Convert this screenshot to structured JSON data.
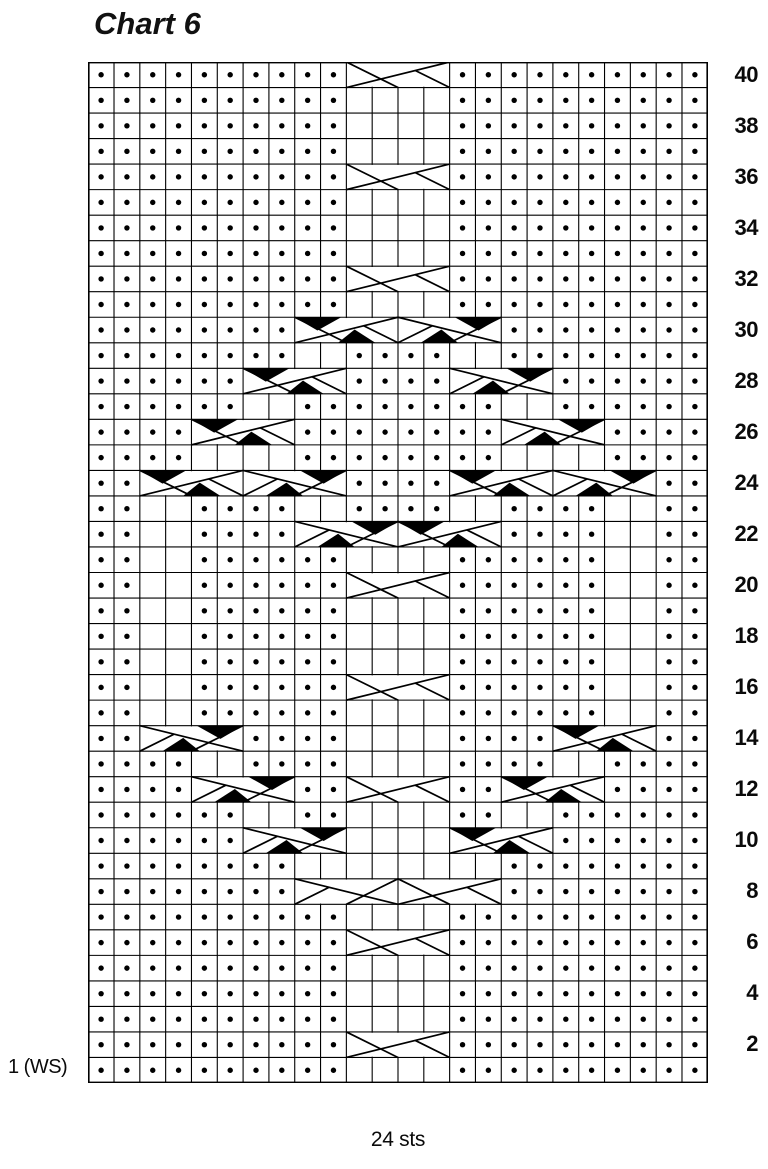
{
  "title": "Chart 6",
  "labels": {
    "row1_left": "1 (WS)",
    "stitch_count": "24 sts"
  },
  "colors": {
    "ink": "#000000",
    "background": "#ffffff"
  },
  "chart": {
    "columns": 24,
    "rows_total": 40,
    "encoding": {
      ".": "purl-dot",
      " ": "knit-blank",
      "R": "cable-4st-right-cross-white",
      "L": "cable-4st-left-cross-white",
      "r": "cable-4st-right-cross-black",
      "l": "cable-4st-left-cross-black",
      "-": "cable-continuation"
    },
    "rows": [
      {
        "n": 40,
        "right": "40",
        "left": "",
        "cells": "..........R---.........."
      },
      {
        "n": 39,
        "right": "",
        "left": "",
        "cells": "..........    .........."
      },
      {
        "n": 38,
        "right": "38",
        "left": "",
        "cells": "..........    .........."
      },
      {
        "n": 37,
        "right": "",
        "left": "",
        "cells": "..........    .........."
      },
      {
        "n": 36,
        "right": "36",
        "left": "",
        "cells": "..........R---.........."
      },
      {
        "n": 35,
        "right": "",
        "left": "",
        "cells": "..........    .........."
      },
      {
        "n": 34,
        "right": "34",
        "left": "",
        "cells": "..........    .........."
      },
      {
        "n": 33,
        "right": "",
        "left": "",
        "cells": "..........    .........."
      },
      {
        "n": 32,
        "right": "32",
        "left": "",
        "cells": "..........R---.........."
      },
      {
        "n": 31,
        "right": "",
        "left": "",
        "cells": "..........    .........."
      },
      {
        "n": 30,
        "right": "30",
        "left": "",
        "cells": "........r---l---........"
      },
      {
        "n": 29,
        "right": "",
        "left": "",
        "cells": "........  ....  ........"
      },
      {
        "n": 28,
        "right": "28",
        "left": "",
        "cells": "......r---....l---......"
      },
      {
        "n": 27,
        "right": "",
        "left": "",
        "cells": "......  ........  ......"
      },
      {
        "n": 26,
        "right": "26",
        "left": "",
        "cells": "....r---........l---...."
      },
      {
        "n": 25,
        "right": "",
        "left": "",
        "cells": "....    ........    ...."
      },
      {
        "n": 24,
        "right": "24",
        "left": "",
        "cells": "..r---l---....r---l---.."
      },
      {
        "n": 23,
        "right": "",
        "left": "",
        "cells": "..  ....  ....  ....  .."
      },
      {
        "n": 22,
        "right": "22",
        "left": "",
        "cells": "..  ....l---r---....  .."
      },
      {
        "n": 21,
        "right": "",
        "left": "",
        "cells": "..  ......    ......  .."
      },
      {
        "n": 20,
        "right": "20",
        "left": "",
        "cells": "..  ......R---......  .."
      },
      {
        "n": 19,
        "right": "",
        "left": "",
        "cells": "..  ......    ......  .."
      },
      {
        "n": 18,
        "right": "18",
        "left": "",
        "cells": "..  ......    ......  .."
      },
      {
        "n": 17,
        "right": "",
        "left": "",
        "cells": "..  ......    ......  .."
      },
      {
        "n": 16,
        "right": "16",
        "left": "",
        "cells": "..  ......R---......  .."
      },
      {
        "n": 15,
        "right": "",
        "left": "",
        "cells": "..  ......    ......  .."
      },
      {
        "n": 14,
        "right": "14",
        "left": "",
        "cells": "..l---....    ....r---.."
      },
      {
        "n": 13,
        "right": "",
        "left": "",
        "cells": "....  ....    ....  ...."
      },
      {
        "n": 12,
        "right": "12",
        "left": "",
        "cells": "....l---..R---..r---...."
      },
      {
        "n": 11,
        "right": "",
        "left": "",
        "cells": "......  ..    ..  ......"
      },
      {
        "n": 10,
        "right": "10",
        "left": "",
        "cells": "......l---    r---......"
      },
      {
        "n": 9,
        "right": "",
        "left": "",
        "cells": "........        ........"
      },
      {
        "n": 8,
        "right": "8",
        "left": "",
        "cells": "........L---R---........"
      },
      {
        "n": 7,
        "right": "",
        "left": "",
        "cells": "..........    .........."
      },
      {
        "n": 6,
        "right": "6",
        "left": "",
        "cells": "..........R---.........."
      },
      {
        "n": 5,
        "right": "",
        "left": "",
        "cells": "..........    .........."
      },
      {
        "n": 4,
        "right": "4",
        "left": "",
        "cells": "..........    .........."
      },
      {
        "n": 3,
        "right": "",
        "left": "",
        "cells": "..........    .........."
      },
      {
        "n": 2,
        "right": "2",
        "left": "",
        "cells": "..........R---.........."
      },
      {
        "n": 1,
        "right": "",
        "left": "1 (WS)",
        "cells": "..........    .........."
      }
    ]
  }
}
